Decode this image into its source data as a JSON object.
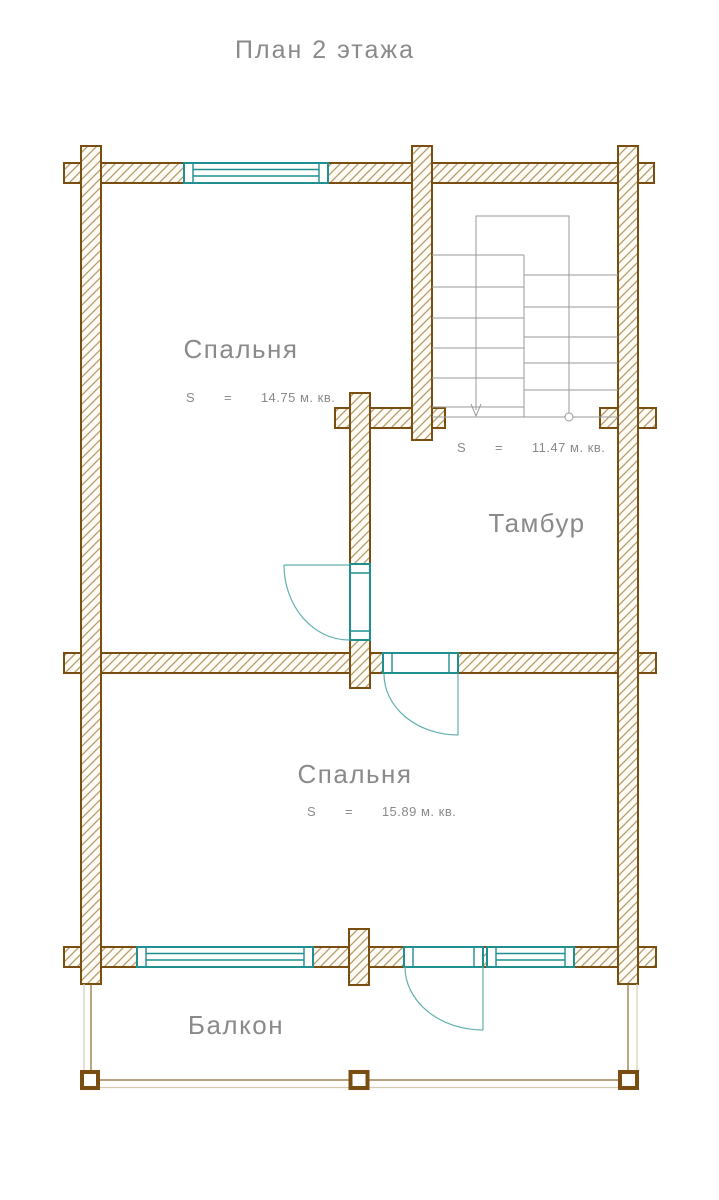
{
  "title": "План 2 этажа",
  "colors": {
    "wall_outline": "#7a4e10",
    "hatch": "#b59a6c",
    "window_frame": "#1f8f8f",
    "door_swing": "#62b0ae",
    "stairs": "#9a9a9a",
    "balcony_dark": "#8a6a33",
    "balcony_light": "#d5cab2",
    "text": "#8a8a8a"
  },
  "rooms": {
    "bedroom_top": {
      "name": "Спальня",
      "area": "S       =       14.75 м. кв."
    },
    "tambour": {
      "name": "Тамбур",
      "area": "S       =       11.47 м. кв."
    },
    "bedroom_bottom": {
      "name": "Спальня",
      "area": "S       =       15.89 м. кв."
    },
    "balcony": {
      "name": "Балкон"
    }
  },
  "symbols": {
    "stairs_direction_marker": "down-arrow",
    "stairs_start_marker": "circle"
  }
}
